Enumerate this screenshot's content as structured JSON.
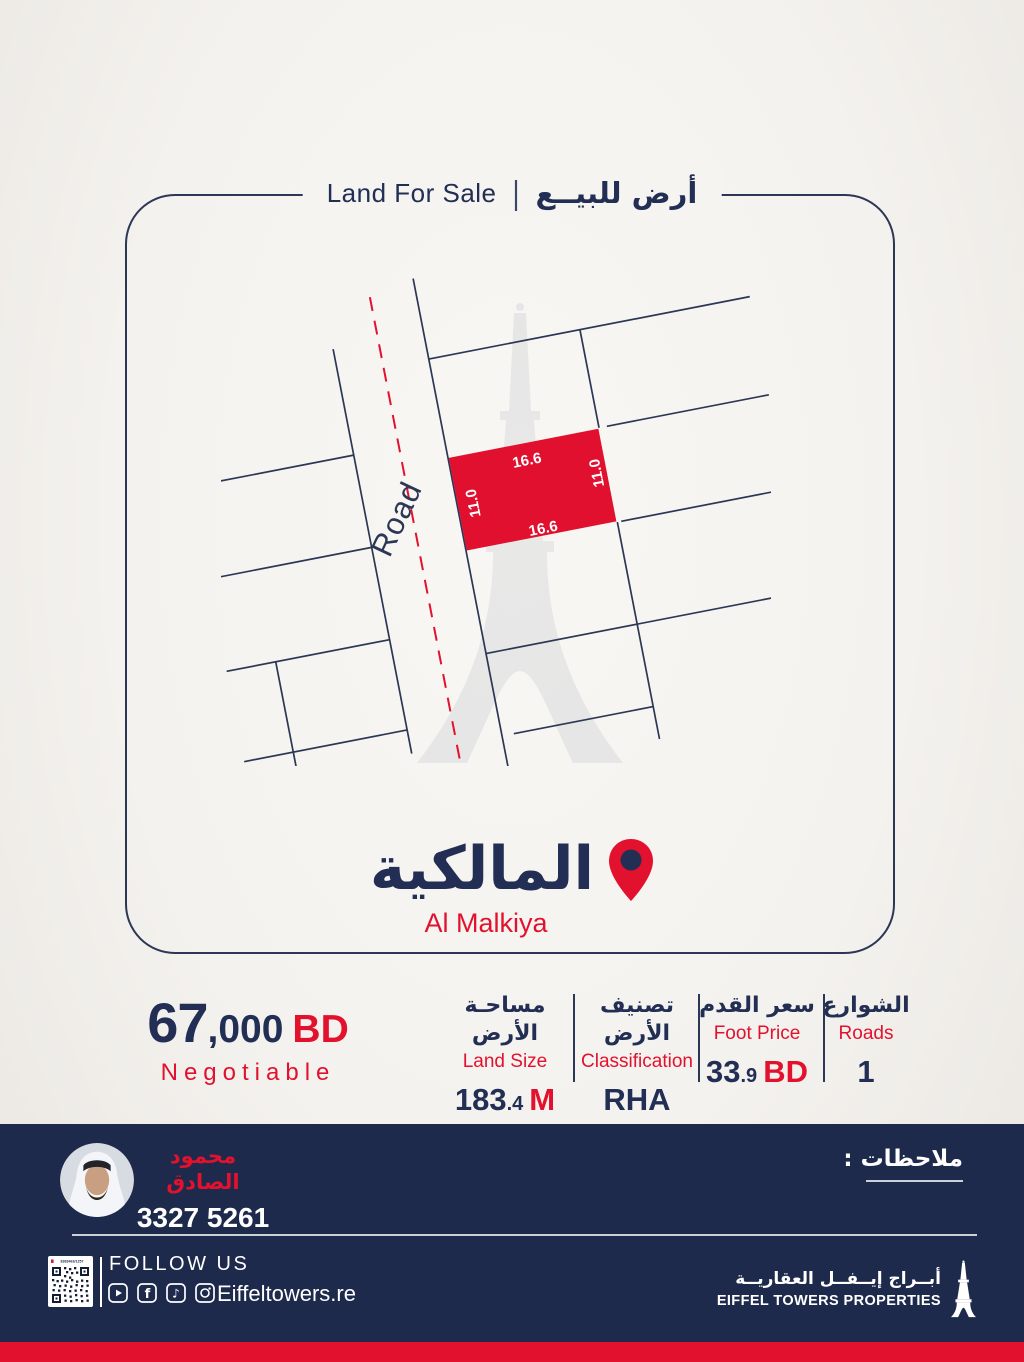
{
  "colors": {
    "navy": "#222e54",
    "band_navy": "#1e2a4c",
    "red": "#e2122e",
    "background": "#f4f2ee",
    "map_line": "#2b3754"
  },
  "header": {
    "title_en": "Land For Sale",
    "separator": "|",
    "title_ar": "أرض للبيــع"
  },
  "map": {
    "road_label": "Road",
    "plot": {
      "top_len": "16.6",
      "bottom_len": "16.6",
      "left_len": "11.0",
      "right_len": "11.0"
    },
    "highlight_color": "#e1102e",
    "watermark": "eiffel-tower-watermark"
  },
  "location": {
    "name_ar": "المالكية",
    "name_en": "Al Malkiya"
  },
  "pricing": {
    "price_main": "67",
    "price_thousands": ",000",
    "currency": "BD",
    "negotiable": "Negotiable"
  },
  "stats": [
    {
      "ar": "مساحـة الأرض",
      "en": "Land Size",
      "value_main": "183",
      "value_dec": ".4",
      "value_unit": "M"
    },
    {
      "ar": "تصنيف الأرض",
      "en": "Classification",
      "value_main": "RHA",
      "value_dec": "",
      "value_unit": ""
    },
    {
      "ar": "سعر القدم",
      "en": "Foot Price",
      "value_main": "33",
      "value_dec": ".9",
      "value_unit": "BD"
    },
    {
      "ar": "الشوارع",
      "en": "Roads",
      "value_main": "1",
      "value_dec": "",
      "value_unit": ""
    }
  ],
  "agent": {
    "name_ar": "محمود الصادق",
    "phone": "3327 5261"
  },
  "notes": {
    "label_ar": "ملاحظات :"
  },
  "footer": {
    "qr_caption": "8383463/1257",
    "follow_us": "FOLLOW US",
    "website": "Eiffeltowers.re",
    "social_icons": [
      "youtube-icon",
      "facebook-icon",
      "tiktok-icon",
      "instagram-icon"
    ],
    "facebook_glyph": "f",
    "tiktok_glyph": "♪",
    "brand_ar": "أبــراج إيــفــل العقاريــة",
    "brand_en": "EIFFEL TOWERS PROPERTIES"
  }
}
